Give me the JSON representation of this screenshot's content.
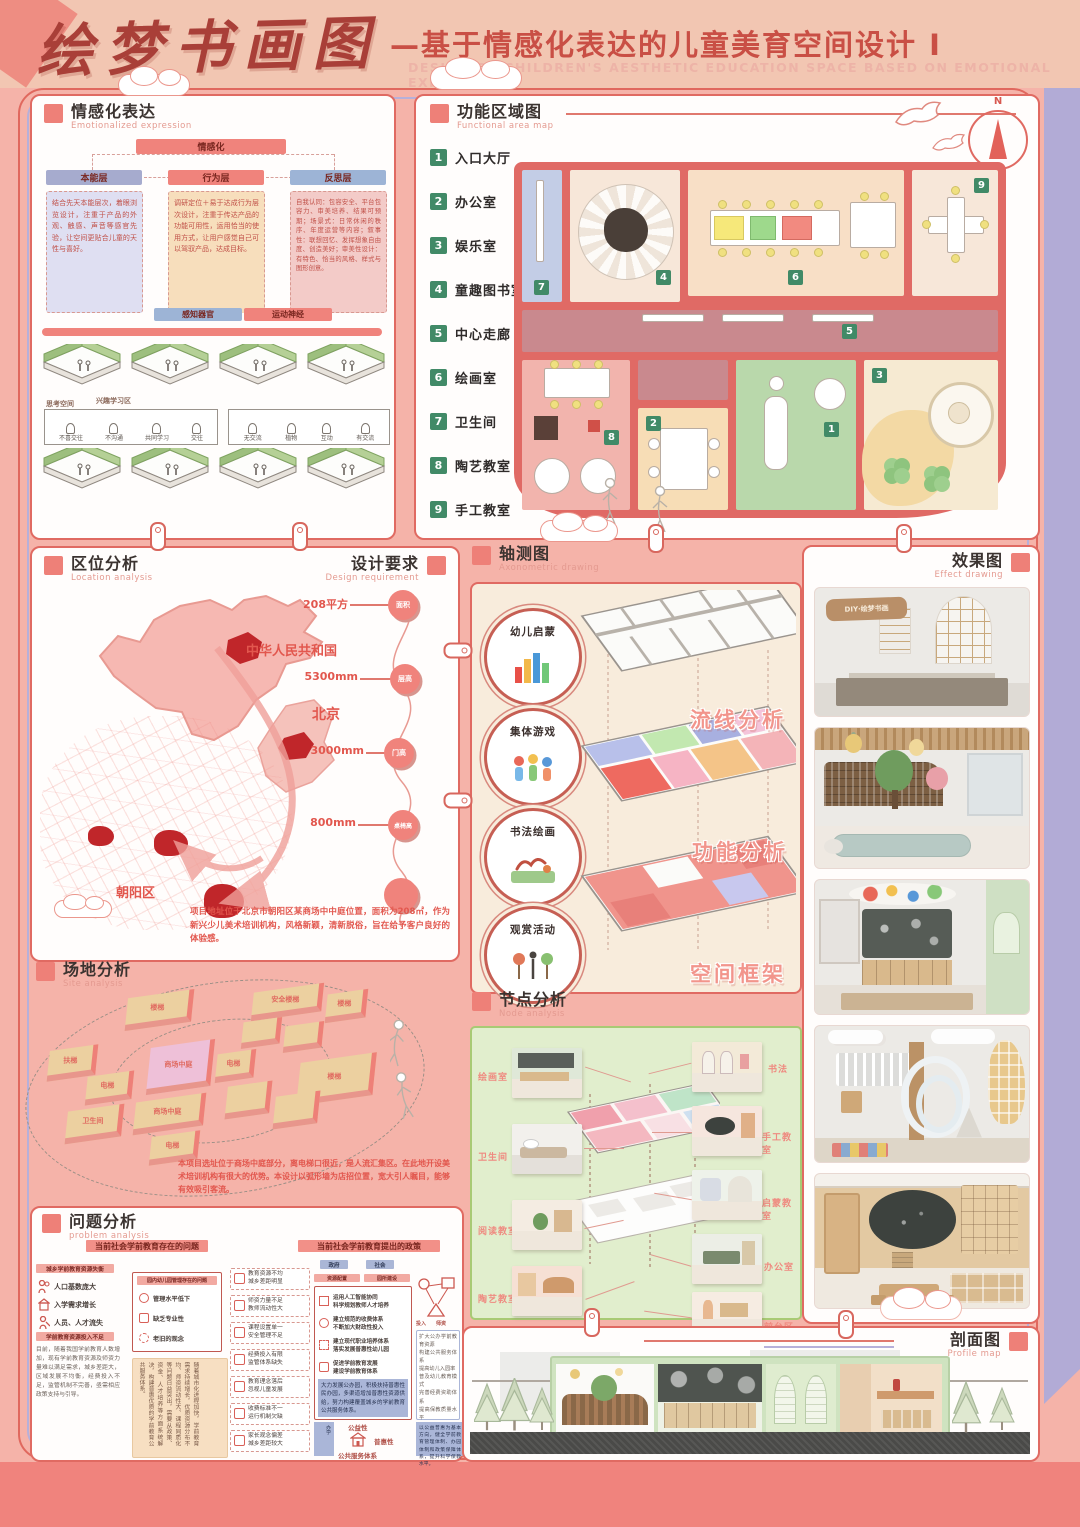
{
  "header": {
    "title_cn": "绘梦书画图",
    "title_sub": "—基于情感化表达的儿童美育空间设计 Ⅰ",
    "subtitle_en": "DESIGN OF CHILDREN'S AESTHETIC EDUCATION SPACE BASED ON EMOTIONAL EXPRESSION"
  },
  "emotional": {
    "title": "情感化表达",
    "subtitle": "Emotionalized expression",
    "root": "情感化",
    "layers": [
      {
        "name": "本能层",
        "text": "结合先天本能层次，着眼浏览设计，注重于产品的外观、触感、声音等感官先验，让空间更贴合儿童的天性与喜好。"
      },
      {
        "name": "行为层",
        "text": "调研定位＋易于达成行为层次设计，注重于传达产品的功能可用性，运用恰当的使用方式，让用户感觉自己可以驾驭产品，达成目标。"
      },
      {
        "name": "反思层",
        "text": "自我认同：包容安全、平台包容力、审美培养、结果可预期；场景式：日常休闲的秩序、年度运营等内容；叙事性：联想回忆、发挥想象自由度、创造美好；审美性设计：有特色、恰当的风格、样式与图形创意。"
      }
    ],
    "bottom": [
      "感知器官",
      "运动神经"
    ],
    "strip1_titles": [
      "思考空间",
      "兴趣学习区"
    ],
    "strip1": [
      "不喜交往",
      "不沟通",
      "共同学习",
      "交往"
    ],
    "strip2": [
      "无交流",
      "植物",
      "互动",
      "有交流"
    ]
  },
  "functional": {
    "title": "功能区域图",
    "subtitle": "Functional area map",
    "compass": "N",
    "legend": [
      {
        "num": 1,
        "label": "入口大厅"
      },
      {
        "num": 2,
        "label": "办公室"
      },
      {
        "num": 3,
        "label": "娱乐室"
      },
      {
        "num": 4,
        "label": "童趣图书室"
      },
      {
        "num": 5,
        "label": "中心走廊"
      },
      {
        "num": 6,
        "label": "绘画室"
      },
      {
        "num": 7,
        "label": "卫生间"
      },
      {
        "num": 8,
        "label": "陶艺教室"
      },
      {
        "num": 9,
        "label": "手工教室"
      }
    ]
  },
  "location": {
    "title": "区位分析",
    "subtitle": "Location analysis",
    "country": "中华人民共和国",
    "city": "北京",
    "district": "朝阳区",
    "description": "项目地址位于北京市朝阳区某商场中中庭位置，面积为208㎡，作为新兴少儿美术培训机构，风格新颖，清新脱俗，旨在给予客户良好的体验感。"
  },
  "design_req": {
    "title": "设计要求",
    "subtitle": "Design requirement",
    "items": [
      {
        "value": "208平方",
        "label": "面积"
      },
      {
        "value": "5300mm",
        "label": "层高"
      },
      {
        "value": "3000mm",
        "label": "门高"
      },
      {
        "value": "800mm",
        "label": "桌椅高"
      }
    ]
  },
  "axon": {
    "title": "轴测图",
    "subtitle": "Axonometric drawing",
    "circles": [
      "幼儿启蒙",
      "集体游戏",
      "书法绘画",
      "观赏活动"
    ],
    "layers": [
      "流线分析",
      "功能分析",
      "空间框架"
    ]
  },
  "effect": {
    "title": "效果图",
    "subtitle": "Effect drawing",
    "sign": "DIY·绘梦书画"
  },
  "site": {
    "title": "场地分析",
    "subtitle": "Site analysis",
    "blocks": [
      "楼梯",
      "安全楼梯",
      "楼梯",
      "扶梯",
      "电梯",
      "商场中庭",
      "电梯",
      "楼梯",
      "商场中庭",
      "卫生间",
      "电梯"
    ],
    "description": "本项目选址位于商场中庭部分，离电梯口很近，是人流汇集区。在此地开设美术培训机构有很大的优势。本设计以弧形墙为店招位置，宽大引人瞩目，能够有效吸引客流。"
  },
  "node": {
    "title": "节点分析",
    "subtitle": "Node analysis",
    "left": [
      "绘画室",
      "卫生间",
      "阅读教室",
      "陶艺教室"
    ],
    "right": [
      "书法",
      "手工教室",
      "启蒙教室",
      "办公室",
      "前台区"
    ]
  },
  "problem": {
    "title": "问题分析",
    "subtitle": "problem analysis",
    "bar_left": "当前社会学前教育存在的问题",
    "bar_right": "当前社会学前教育提出的政策",
    "chips": [
      "政府",
      "社会"
    ],
    "sub1": "城乡学前教育资源失衡",
    "sub2": "学前教育资源投入不足",
    "stats": [
      "人口基数庞大",
      "入学需求增长",
      "人员、人才流失"
    ],
    "note_left": "目前，随着我国学前教育人数增加，现有学前教育资源及师资力量难以满足需求，城乡差距大，区域发展不均衡，经费投入不足，监管机制不完善，亟需相应政策支持与引导。",
    "mgmt_title": "园内幼儿园管理存在的问题",
    "mgmt": [
      "管理水平低下",
      "缺乏专业性",
      "老旧的观念"
    ],
    "note_vertical": "随着城市化进程加快，学前教育需求持续增长，优质资源分布不均、师资流动性大、课程同质化等问题日益突出，需要从政策、资金、人才培养等方面系统解决，构建普惠优质的学前教育公共服务体系。",
    "issues": [
      {
        "a": "教育资源不均",
        "b": "城乡差距明显"
      },
      {
        "a": "师资力量不足",
        "b": "教师流动性大"
      },
      {
        "a": "课程设置单一",
        "b": "安全管理不足"
      },
      {
        "a": "经费投入有限",
        "b": "监管体系缺失"
      },
      {
        "a": "教育理念落后",
        "b": "忽视儿童发展"
      },
      {
        "a": "收费标准不一",
        "b": "运行机制欠缺"
      },
      {
        "a": "家长观念偏差",
        "b": "城乡差距较大"
      }
    ],
    "pchips": [
      "资源配置",
      "园所建设",
      "城镇化影响",
      "资源供给"
    ],
    "policy1": [
      {
        "a": "运用人工智能协同",
        "b": "科学规划教师人才培养"
      },
      {
        "a": "建立规范的收费体系",
        "b": "不断加大财政性投入"
      },
      {
        "a": "建立现代职业培养体系",
        "b": "落实发展普惠性幼儿园"
      },
      {
        "a": "促进学前教育发展",
        "b": "建设学前教育体系"
      }
    ],
    "policy1_note": "大力发展公办园，积极扶持普惠性民办园，多渠道增加普惠性资源供给，努力构建覆盖城乡的学前教育公共服务体系。",
    "policy2": [
      {
        "a": "扩大公办学前教育资源",
        "b": "构建公共服务体系"
      },
      {
        "a": "提高幼儿入园率",
        "b": "普及幼儿教育模式"
      },
      {
        "a": "完善经费资助体系",
        "b": "提高保教质量水平"
      }
    ],
    "policy2_note": "以公益普惠为基本方向，健全学前教育管理体制、办园体制和政策保障体系，提升科学保教水平。",
    "net_labels": [
      "投入",
      "师资",
      "办学"
    ],
    "tags": [
      "公益性",
      "普惠性",
      "公共服务体系"
    ]
  },
  "section": {
    "title": "剖面图",
    "subtitle": "Profile map"
  }
}
